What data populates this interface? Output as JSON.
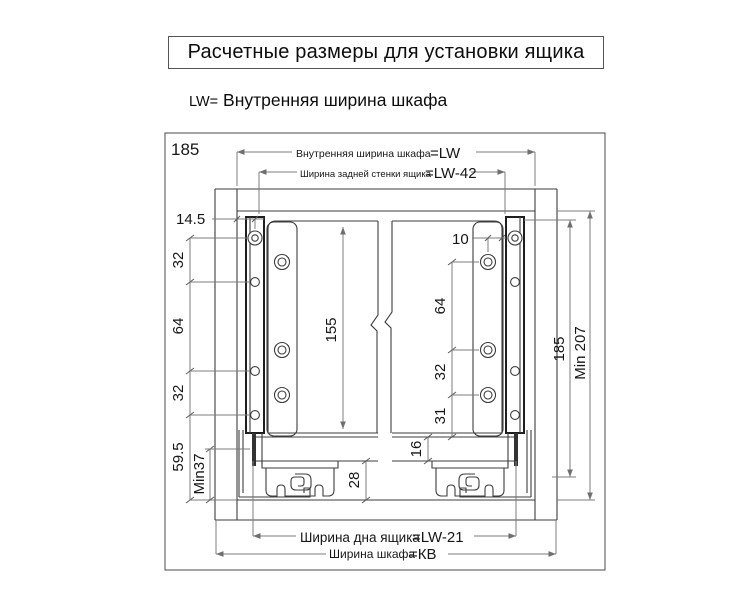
{
  "title": "Расчетные размеры для установки ящика",
  "subtitle": {
    "prefix": "LW=",
    "text": " Внутренняя ширина шкафа"
  },
  "drawing": {
    "corner_label": "185",
    "dims": {
      "inner_width": {
        "label": "Внутренняя ширина шкафа",
        "value": "=LW"
      },
      "back_width": {
        "label": "Ширина задней стенки ящика",
        "value": "=LW-42"
      },
      "bottom_width": {
        "label": "Ширина дна ящика",
        "value": "=LW-21"
      },
      "cabinet_width": {
        "label": "Ширина шкафа",
        "value": "=КВ"
      },
      "side_offset": "14.5",
      "left_chain": [
        "32",
        "64",
        "32",
        "59.5",
        "Min37"
      ],
      "back_height": "155",
      "hole_offset": "10",
      "right_chain": [
        "64",
        "32",
        "31",
        "16"
      ],
      "bottom_clearance": "28",
      "rail_height": "185",
      "min_height": "Min 207"
    }
  }
}
